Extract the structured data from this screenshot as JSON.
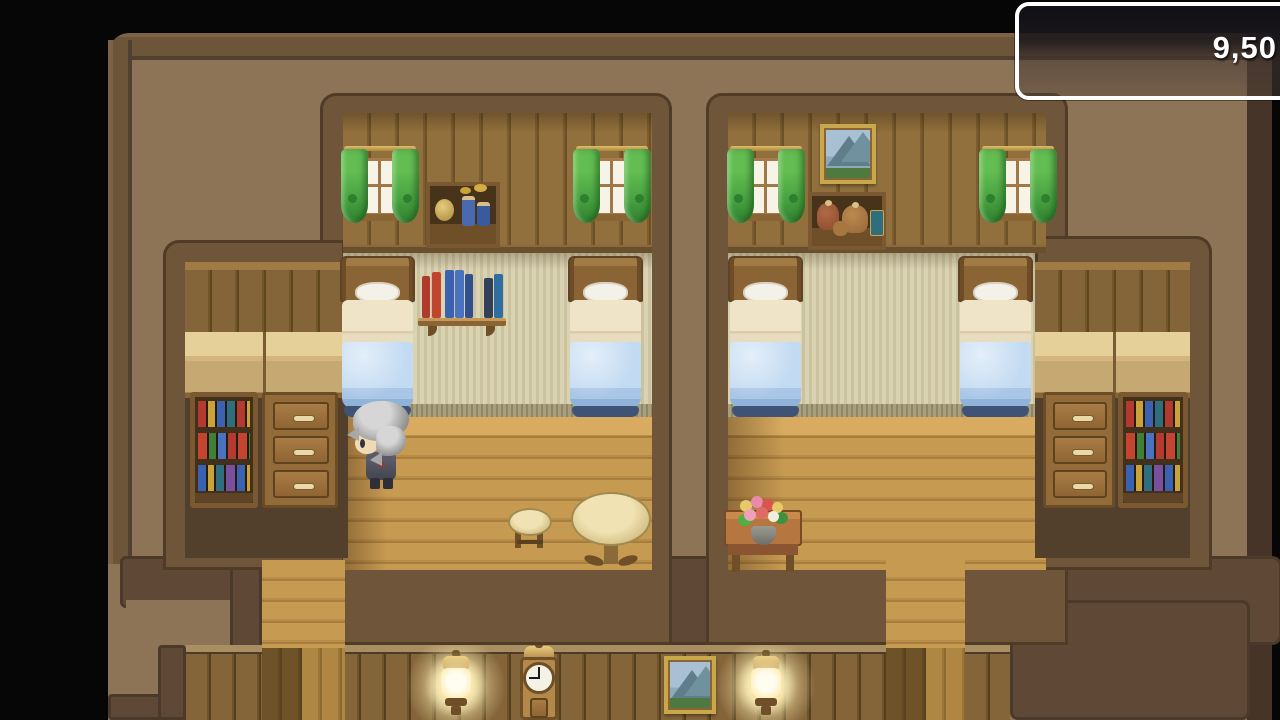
{
  "hud": {
    "gold_window": {
      "visible_text": "9,50"
    }
  },
  "colors": {
    "background": "#060606",
    "exterior_tan": "#8d7456",
    "exterior_border": "#6d5539",
    "wall_band": "#5f4936",
    "room_border": "#6f553a",
    "plank_wall": "#91703e",
    "inner_wall_beige": "#d9d3b4",
    "floor_wood": "#c79a52",
    "curtain_green": "#46a03f",
    "blanket_blue": "#b9d4ee",
    "lamp_glow": "#fff3be",
    "gold_window_border": "#ffffff",
    "gold_text": "#ffffff"
  },
  "scene": {
    "type": "rpg-inn-interior",
    "rooms": [
      {
        "name": "left-bedroom",
        "objects": [
          "window-green-curtains",
          "jar-shelf",
          "window-green-curtains",
          "bed-blue-blanket",
          "wall-book-shelf",
          "bed-blue-blanket",
          "bookshelf",
          "dresser",
          "stool",
          "round-table",
          "player-character"
        ]
      },
      {
        "name": "right-bedroom",
        "objects": [
          "window-green-curtains",
          "mountain-picture",
          "sack-shelf",
          "window-green-curtains",
          "bed-blue-blanket",
          "bed-blue-blanket",
          "dresser",
          "bookshelf",
          "flower-table"
        ]
      },
      {
        "name": "hallway-room",
        "objects": [
          "wall-lamp",
          "grandfather-clock",
          "mountain-picture",
          "wall-lamp"
        ]
      }
    ],
    "player_character": "gray-haired hero facing left"
  }
}
